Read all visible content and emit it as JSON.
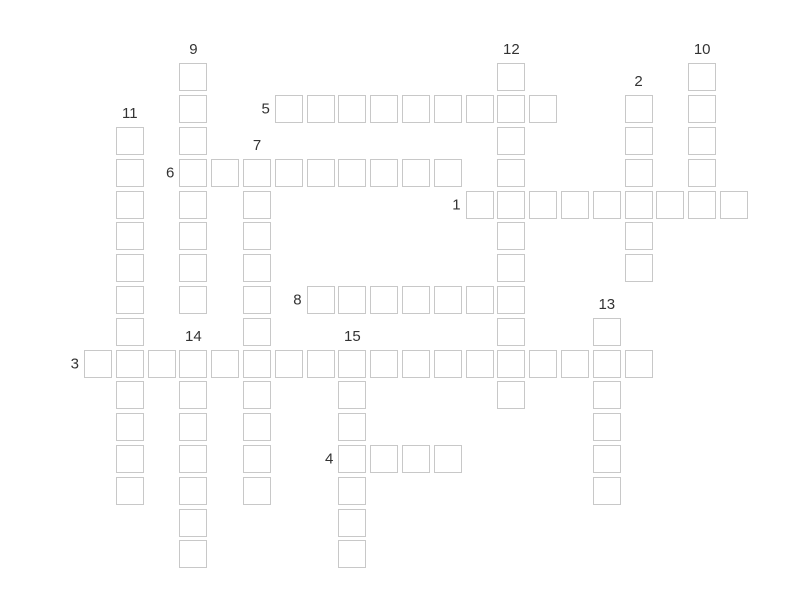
{
  "page": {
    "background_color": "#ffffff"
  },
  "puzzle": {
    "kind": "crossword-grid",
    "state": "empty",
    "cell_border_color": "#c8c8c8",
    "cell_fill_color": "#ffffff",
    "number_color": "#333333",
    "across_words": [
      {
        "number": "1",
        "row": 4,
        "col": 12,
        "length": 9
      },
      {
        "number": "3",
        "row": 9,
        "col": 0,
        "length": 18
      },
      {
        "number": "4",
        "row": 12,
        "col": 8,
        "length": 4
      },
      {
        "number": "5",
        "row": 1,
        "col": 6,
        "length": 9
      },
      {
        "number": "6",
        "row": 3,
        "col": 3,
        "length": 9
      },
      {
        "number": "8",
        "row": 7,
        "col": 7,
        "length": 7
      }
    ],
    "down_words": [
      {
        "number": "2",
        "row": 1,
        "col": 17,
        "length": 6
      },
      {
        "number": "7",
        "row": 3,
        "col": 5,
        "length": 11
      },
      {
        "number": "9",
        "row": 0,
        "col": 3,
        "length": 8
      },
      {
        "number": "10",
        "row": 0,
        "col": 19,
        "length": 5
      },
      {
        "number": "11",
        "row": 2,
        "col": 1,
        "length": 12
      },
      {
        "number": "12",
        "row": 0,
        "col": 13,
        "length": 11
      },
      {
        "number": "13",
        "row": 8,
        "col": 16,
        "length": 6
      },
      {
        "number": "14",
        "row": 9,
        "col": 3,
        "length": 7
      },
      {
        "number": "15",
        "row": 9,
        "col": 8,
        "length": 7
      }
    ]
  }
}
